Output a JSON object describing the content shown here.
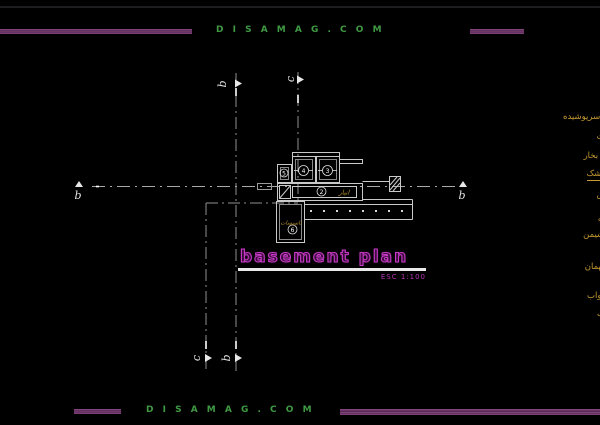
{
  "window": {
    "background": "#000000"
  },
  "branding": {
    "top_text": "D I S A M A G . C O M",
    "bottom_text": "D I S A M A G . C O M",
    "text_color": "#3f9a43",
    "bar_color": "#7d4079"
  },
  "title_block": {
    "title": "basement plan",
    "scale": "ESC  1:100",
    "title_color": "#c73ac7",
    "underline_color": "#e9e9e9"
  },
  "section_markers": {
    "b_left": "b",
    "b_right": "b",
    "b_top": "b",
    "b_bottom": "b",
    "c_top": "c",
    "c_bottom": "c"
  },
  "plan": {
    "wall_color": "#c9c9c9",
    "room_labels": [
      {
        "text": "انبار",
        "color": "#b8922c"
      },
      {
        "text": "تاسیسات",
        "color": "#b8922c"
      }
    ],
    "room_tags": [
      {
        "number": "5"
      },
      {
        "number": "4"
      },
      {
        "number": "3"
      },
      {
        "number": "2"
      },
      {
        "number": "6"
      }
    ]
  },
  "legend": {
    "color": "#c79b33",
    "items": [
      {
        "text": "ر سرپوشیده",
        "top": 112,
        "underline": false
      },
      {
        "text": "ات",
        "top": 132,
        "underline": false
      },
      {
        "text": "ل بخار",
        "top": 151,
        "underline": false
      },
      {
        "text": "خشک",
        "top": 169,
        "underline": true
      },
      {
        "text": "س",
        "top": 190,
        "underline": false
      },
      {
        "text": "ی",
        "top": 204,
        "underline": false
      },
      {
        "text": "انه",
        "top": 214,
        "underline": false
      },
      {
        "text": "نشیمن",
        "top": 230,
        "underline": false
      },
      {
        "text": "د",
        "top": 245,
        "underline": false
      },
      {
        "text": "مهمان",
        "top": 262,
        "underline": false
      },
      {
        "text": "خواب",
        "top": 291,
        "underline": false
      },
      {
        "text": "نگ",
        "top": 309,
        "underline": false
      }
    ]
  }
}
